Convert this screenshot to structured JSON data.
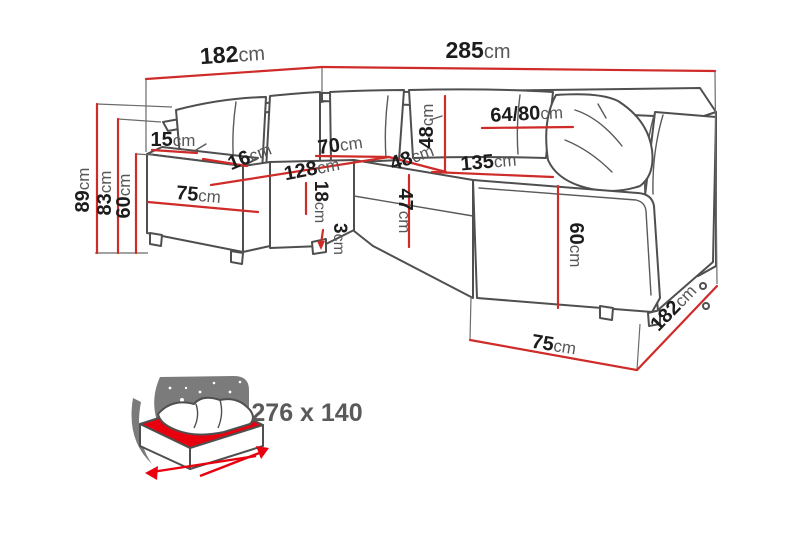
{
  "diagram": {
    "title": "corner-sofa-dimension-diagram",
    "colors": {
      "dimension_line_red": "#cf2b28",
      "sofa_outline_grey": "#4f4f4f",
      "number_black": "#1c1c1c",
      "unit_grey": "#575757",
      "icon_sky_grey": "#7b7b7b",
      "icon_red": "#e8000f"
    },
    "dims": {
      "width_left": {
        "value": "182",
        "unit": "cm"
      },
      "width_right": {
        "value": "285",
        "unit": "cm"
      },
      "height_total": {
        "value": "89",
        "unit": "cm"
      },
      "height_backrest": {
        "value": "83",
        "unit": "cm"
      },
      "height_seatback": {
        "value": "60",
        "unit": "cm"
      },
      "armrest_top_width": {
        "value": "15",
        "unit": "cm"
      },
      "back_cushion": {
        "value": "16",
        "unit": "cm"
      },
      "arm_depth_left": {
        "value": "75",
        "unit": "cm"
      },
      "corner_seat_width": {
        "value": "70",
        "unit": "cm"
      },
      "seat_length_left": {
        "value": "128",
        "unit": "cm"
      },
      "seat_cushion_h": {
        "value": "18",
        "unit": "cm"
      },
      "leg_height": {
        "value": "3",
        "unit": "cm"
      },
      "back_height_48": {
        "value": "48",
        "unit": "cm"
      },
      "seat_depth_48": {
        "value": "48",
        "unit": "cm"
      },
      "seat_front_h": {
        "value": "47",
        "unit": "cm"
      },
      "cushion_range": {
        "value": "64/80",
        "unit": "cm"
      },
      "seat_length_right": {
        "value": "135",
        "unit": "cm"
      },
      "arm_height_right": {
        "value": "60",
        "unit": "cm"
      },
      "arm_depth_right": {
        "value": "75",
        "unit": "cm"
      },
      "depth_right": {
        "value": "182",
        "unit": "cm"
      }
    },
    "sleeping_function": {
      "icon": "sofa-bed-sleeping-icon",
      "size_label": "276 x 140"
    }
  }
}
